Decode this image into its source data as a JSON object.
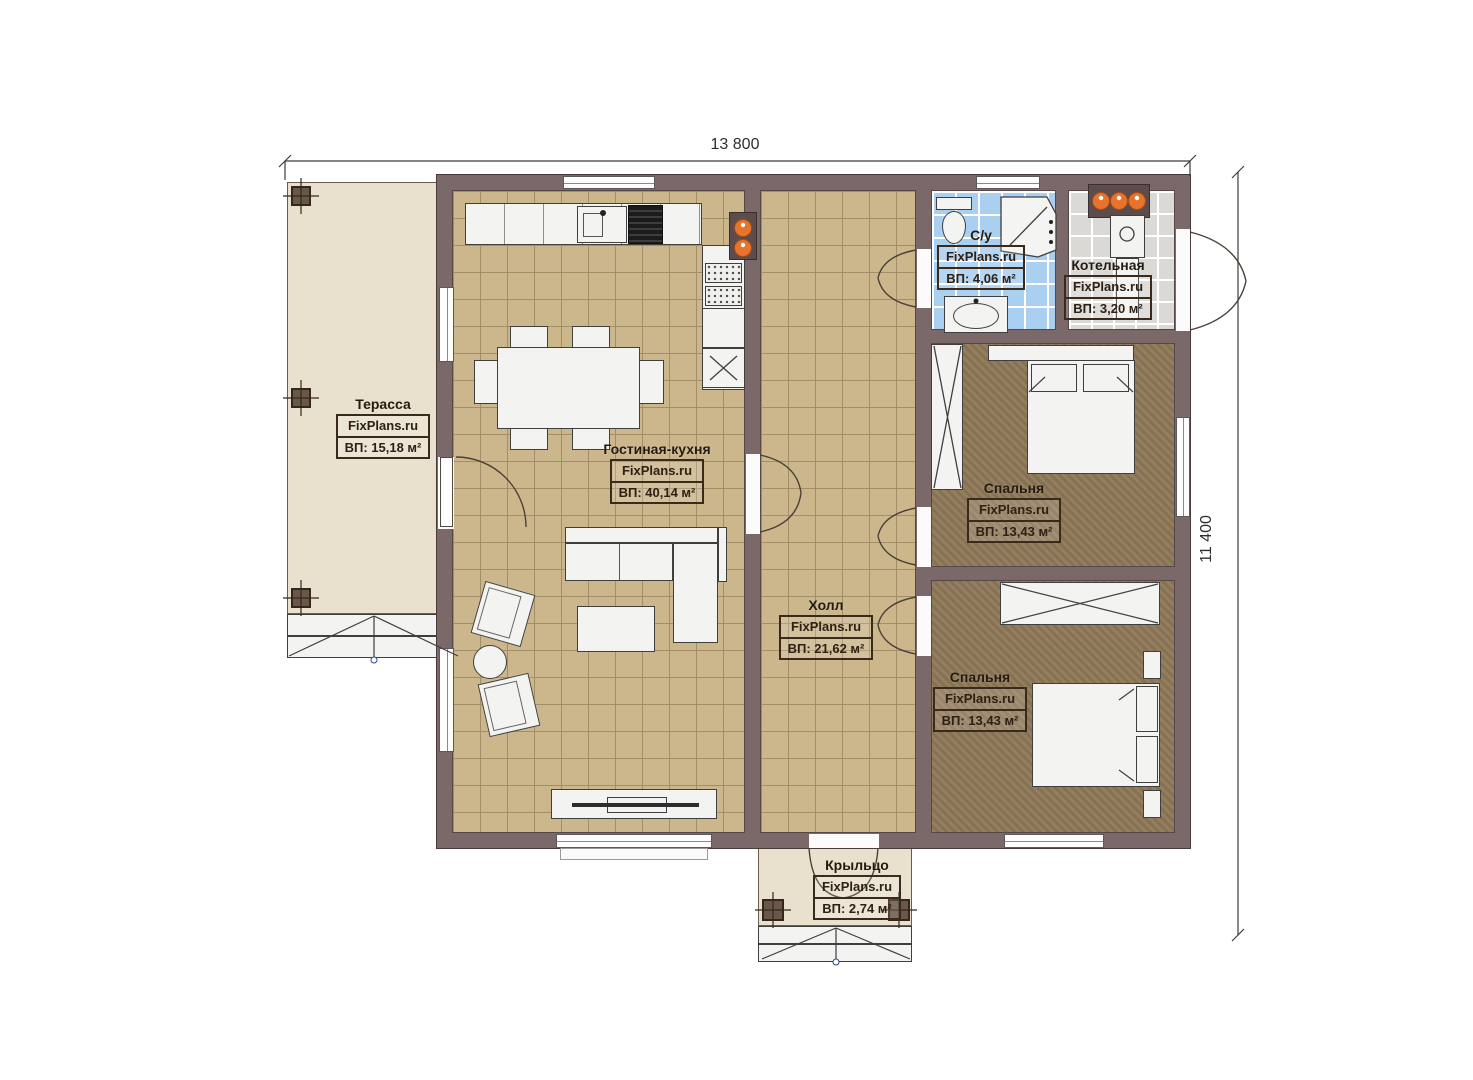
{
  "watermark": "FixPlans.ru",
  "dimensions": {
    "width_label": "13 800",
    "height_label": "11 400"
  },
  "rooms": [
    {
      "key": "terrace",
      "name": "Терасса",
      "brand": "FixPlans.ru",
      "area": "ВП: 15,18 м²"
    },
    {
      "key": "living-kitchen",
      "name": "Гостиная-кухня",
      "brand": "FixPlans.ru",
      "area": "ВП: 40,14 м²"
    },
    {
      "key": "hall",
      "name": "Холл",
      "brand": "FixPlans.ru",
      "area": "ВП: 21,62 м²"
    },
    {
      "key": "bathroom",
      "name": "С/у",
      "brand": "FixPlans.ru",
      "area": "ВП: 4,06 м²"
    },
    {
      "key": "boiler-room",
      "name": "Котельная",
      "brand": "FixPlans.ru",
      "area": "ВП: 3,20 м²"
    },
    {
      "key": "bedroom-top",
      "name": "Спальня",
      "brand": "FixPlans.ru",
      "area": "ВП: 13,43 м²"
    },
    {
      "key": "bedroom-bottom",
      "name": "Спальня",
      "brand": "FixPlans.ru",
      "area": "ВП: 13,43 м²"
    },
    {
      "key": "porch",
      "name": "Крыльцо",
      "brand": "FixPlans.ru",
      "area": "ВП: 2,74 м²"
    }
  ],
  "colors": {
    "wall": "#7b6868",
    "floor_tile_tan": "#ccb78d",
    "floor_bedroom": "#8e7757",
    "floor_bath": "#a9d0f1",
    "floor_boiler": "#dad9d6",
    "floor_terrace": "#e9e0cd",
    "accent_burner": "#e8732c"
  }
}
